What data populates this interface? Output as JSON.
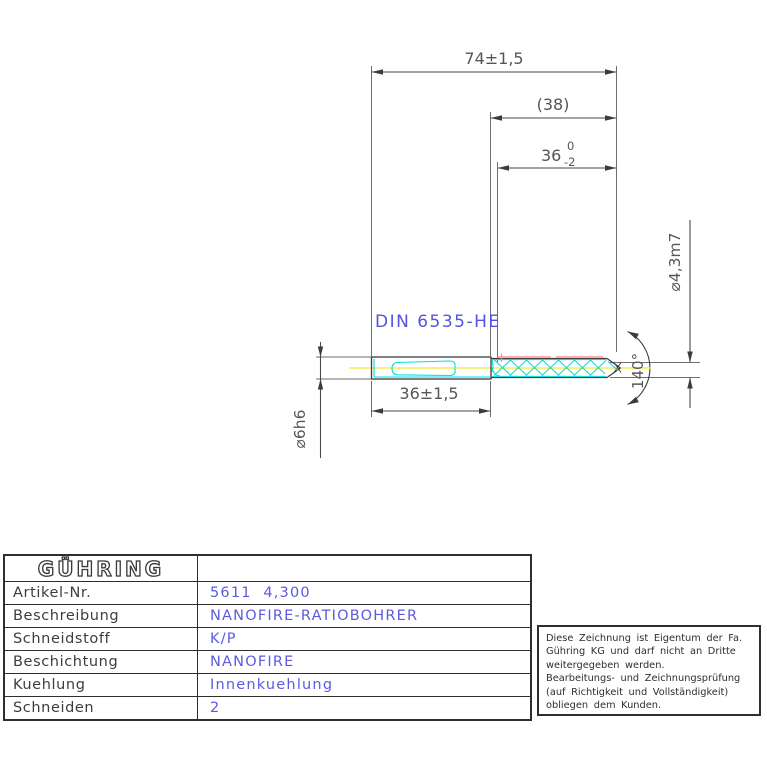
{
  "drawing": {
    "din_label": "DIN 6535-HE",
    "dims": {
      "overall_length": "74±1,5",
      "flute_ref_length": "(38)",
      "flute_length_base": "36",
      "flute_tol_upper": "0",
      "flute_tol_lower": "-2",
      "tip_diameter": "⌀4,3m7",
      "shank_clamp_length": "36±1,5",
      "shank_diameter": "⌀6h6",
      "point_angle": "140°"
    },
    "colors": {
      "outline": "#3c3c3c",
      "dimension": "#4a4a4a",
      "extension": "#6e6e6e",
      "dim_text": "#565656",
      "highlight_cyan": "#00dede",
      "highlight_red": "#ff8a8a",
      "centerline_yellow": "#f0ef55",
      "annotation_blue": "#5353dd"
    }
  },
  "table": {
    "brand": "GÜHRING",
    "rows": [
      {
        "label": "Artikel-Nr.",
        "value": "5611  4,300"
      },
      {
        "label": "Beschreibung",
        "value": "NANOFIRE-RATIOBOHRER"
      },
      {
        "label": "Schneidstoff",
        "value": "K/P"
      },
      {
        "label": "Beschichtung",
        "value": "NANOFIRE"
      },
      {
        "label": "Kuehlung",
        "value": "Innenkuehlung"
      },
      {
        "label": "Schneiden",
        "value": "2"
      }
    ]
  },
  "note": {
    "text": "Diese Zeichnung ist Eigentum der Fa.\nGühring KG und darf nicht an Dritte\nweitergegeben werden.\nBearbeitungs- und Zeichnungsprüfung\n(auf Richtigkeit und Vollständigkeit)\nobliegen dem Kunden."
  }
}
